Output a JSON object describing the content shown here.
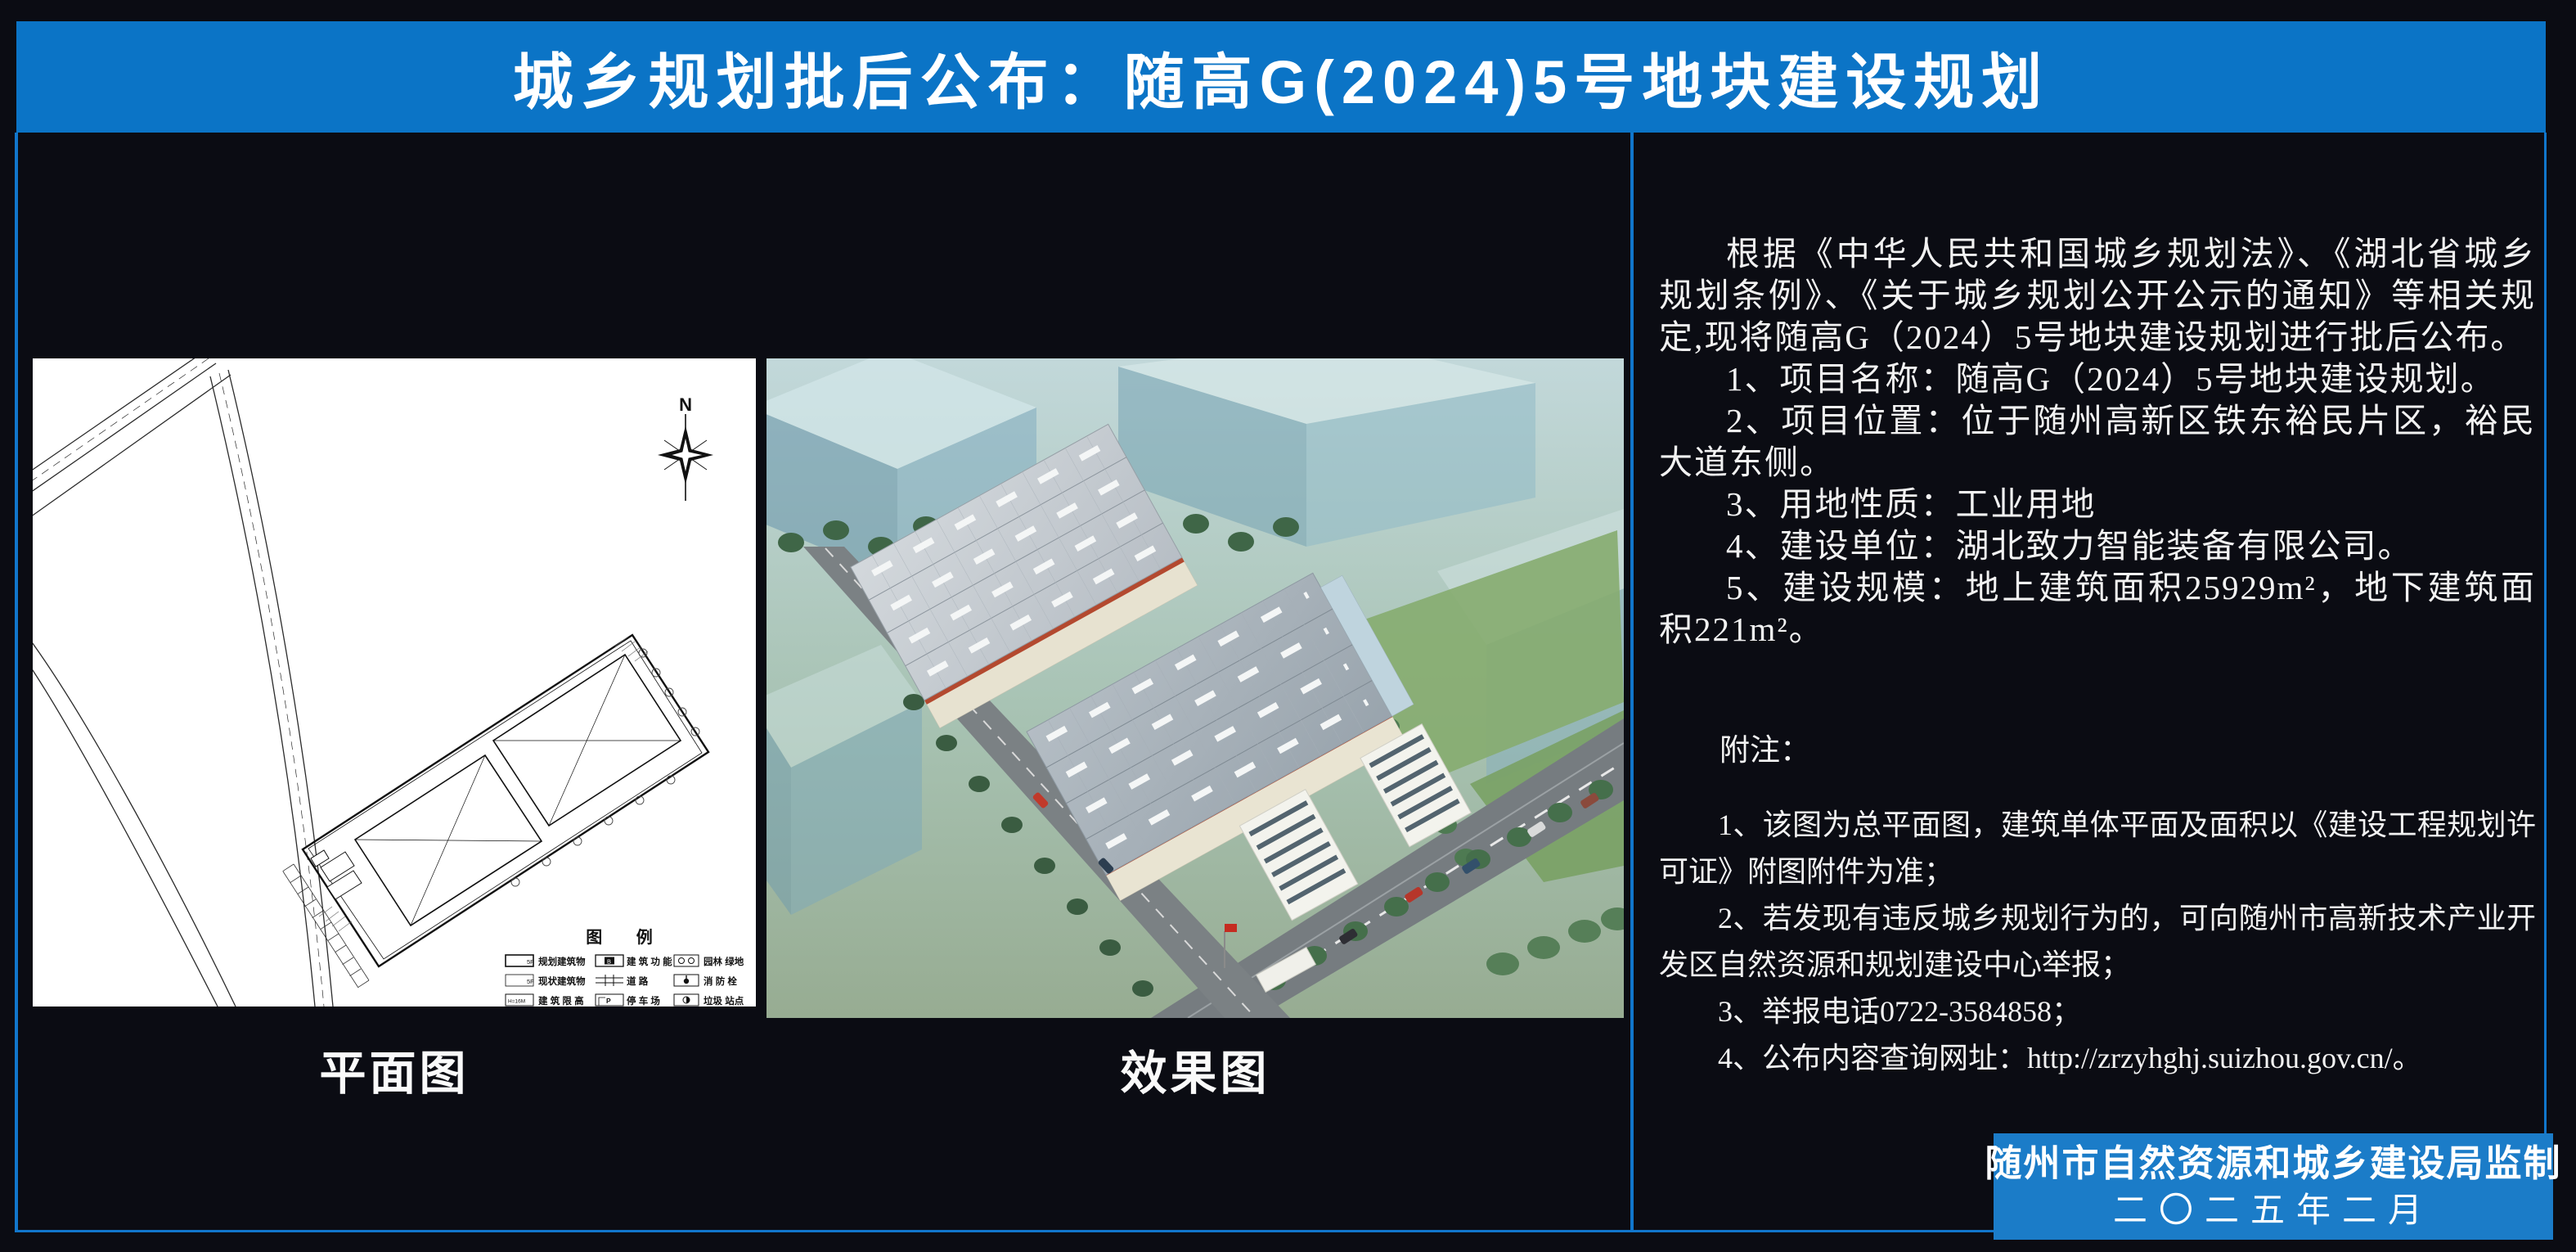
{
  "page": {
    "bg": "#0B0C13",
    "frame_color": "#1176CB"
  },
  "banner": {
    "title": "城乡规划批后公布：随高G(2024)5号地块建设规划",
    "bg": "#0B74C6"
  },
  "left": {
    "caption": "平面图",
    "compass_label": "N",
    "legend": {
      "title": "图  例",
      "items": [
        {
          "label": "规划建筑物",
          "sym": "5F"
        },
        {
          "label": "建 筑 功 能",
          "sym": "B"
        },
        {
          "label": "园林 绿地",
          "sym": ""
        },
        {
          "label": "现状建筑物",
          "sym": "5F"
        },
        {
          "label": "道    路",
          "sym": ""
        },
        {
          "label": "消 防 栓",
          "sym": ""
        },
        {
          "label": "建 筑 限 高",
          "sym": "H=16M"
        },
        {
          "label": "停 车 场",
          "sym": "P"
        },
        {
          "label": "垃圾 站点",
          "sym": ""
        }
      ]
    }
  },
  "middle": {
    "caption": "效果图"
  },
  "right": {
    "paragraphs": [
      "根据《中华人民共和国城乡规划法》、《湖北省城乡规划条例》、《关于城乡规划公开公示的通知》等相关规定,现将随高G（2024）5号地块建设规划进行批后公布。",
      "1、项目名称：随高G（2024）5号地块建设规划。",
      "2、项目位置：位于随州高新区铁东裕民片区，裕民大道东侧。",
      "3、用地性质：工业用地",
      "4、建设单位：湖北致力智能装备有限公司。",
      "5、建设规模：地上建筑面积25929m²，地下建筑面积221m²。"
    ],
    "notes_heading": "附注：",
    "notes": [
      "1、该图为总平面图，建筑单体平面及面积以《建设工程规划许可证》附图附件为准；",
      "2、若发现有违反城乡规划行为的，可向随州市高新技术产业开发区自然资源和规划建设中心举报；",
      "3、举报电话0722-3584858；",
      "4、公布内容查询网址：http://zrzyhghj.suizhou.gov.cn/。"
    ],
    "footer": {
      "line1": "随州市自然资源和城乡建设局监制",
      "line2": "二〇二五年二月",
      "bg": "#1B7CC8"
    }
  }
}
